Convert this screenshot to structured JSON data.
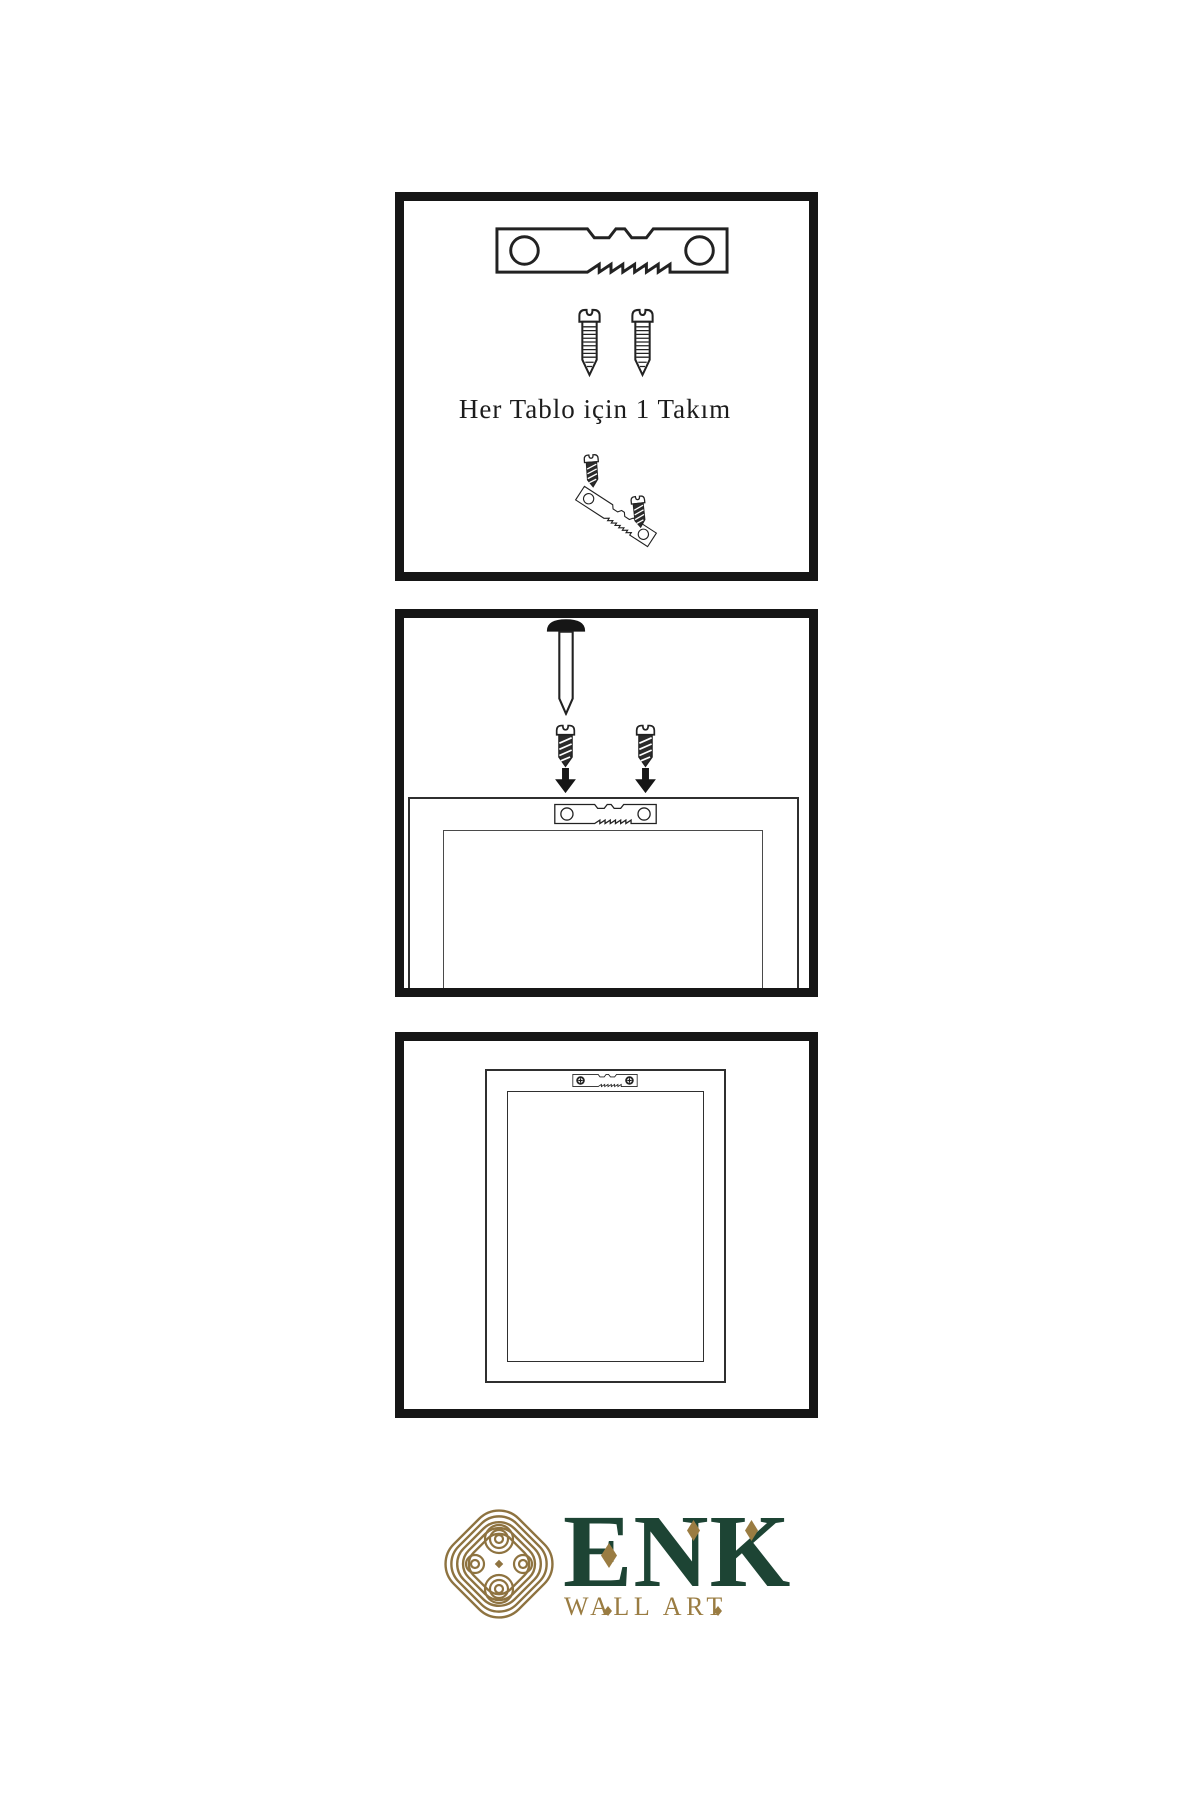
{
  "colors": {
    "background": "#ffffff",
    "line_art": "#222222",
    "panel_border": "#161616",
    "brand_green": "#1d4434",
    "brand_gold": "#9a7c42"
  },
  "steps": [
    {
      "name": "hardware-kit",
      "caption": "Her Tablo için 1 Takım",
      "items": [
        "sawtooth-hanger",
        "screw",
        "screw",
        "screw-into-tilted-hanger",
        "screw"
      ]
    },
    {
      "name": "attach-hanger-to-frame-back",
      "items": [
        "wall-nail",
        "screw",
        "screw",
        "down-arrow",
        "down-arrow",
        "sawtooth-hanger-on-frame-back"
      ]
    },
    {
      "name": "hang-frame-on-wall",
      "items": [
        "framed-picture-with-installed-sawtooth-hanger"
      ]
    }
  ],
  "logo": {
    "brand": "ENK",
    "tagline": "WALL ART",
    "icon": "interlaced-knot"
  }
}
